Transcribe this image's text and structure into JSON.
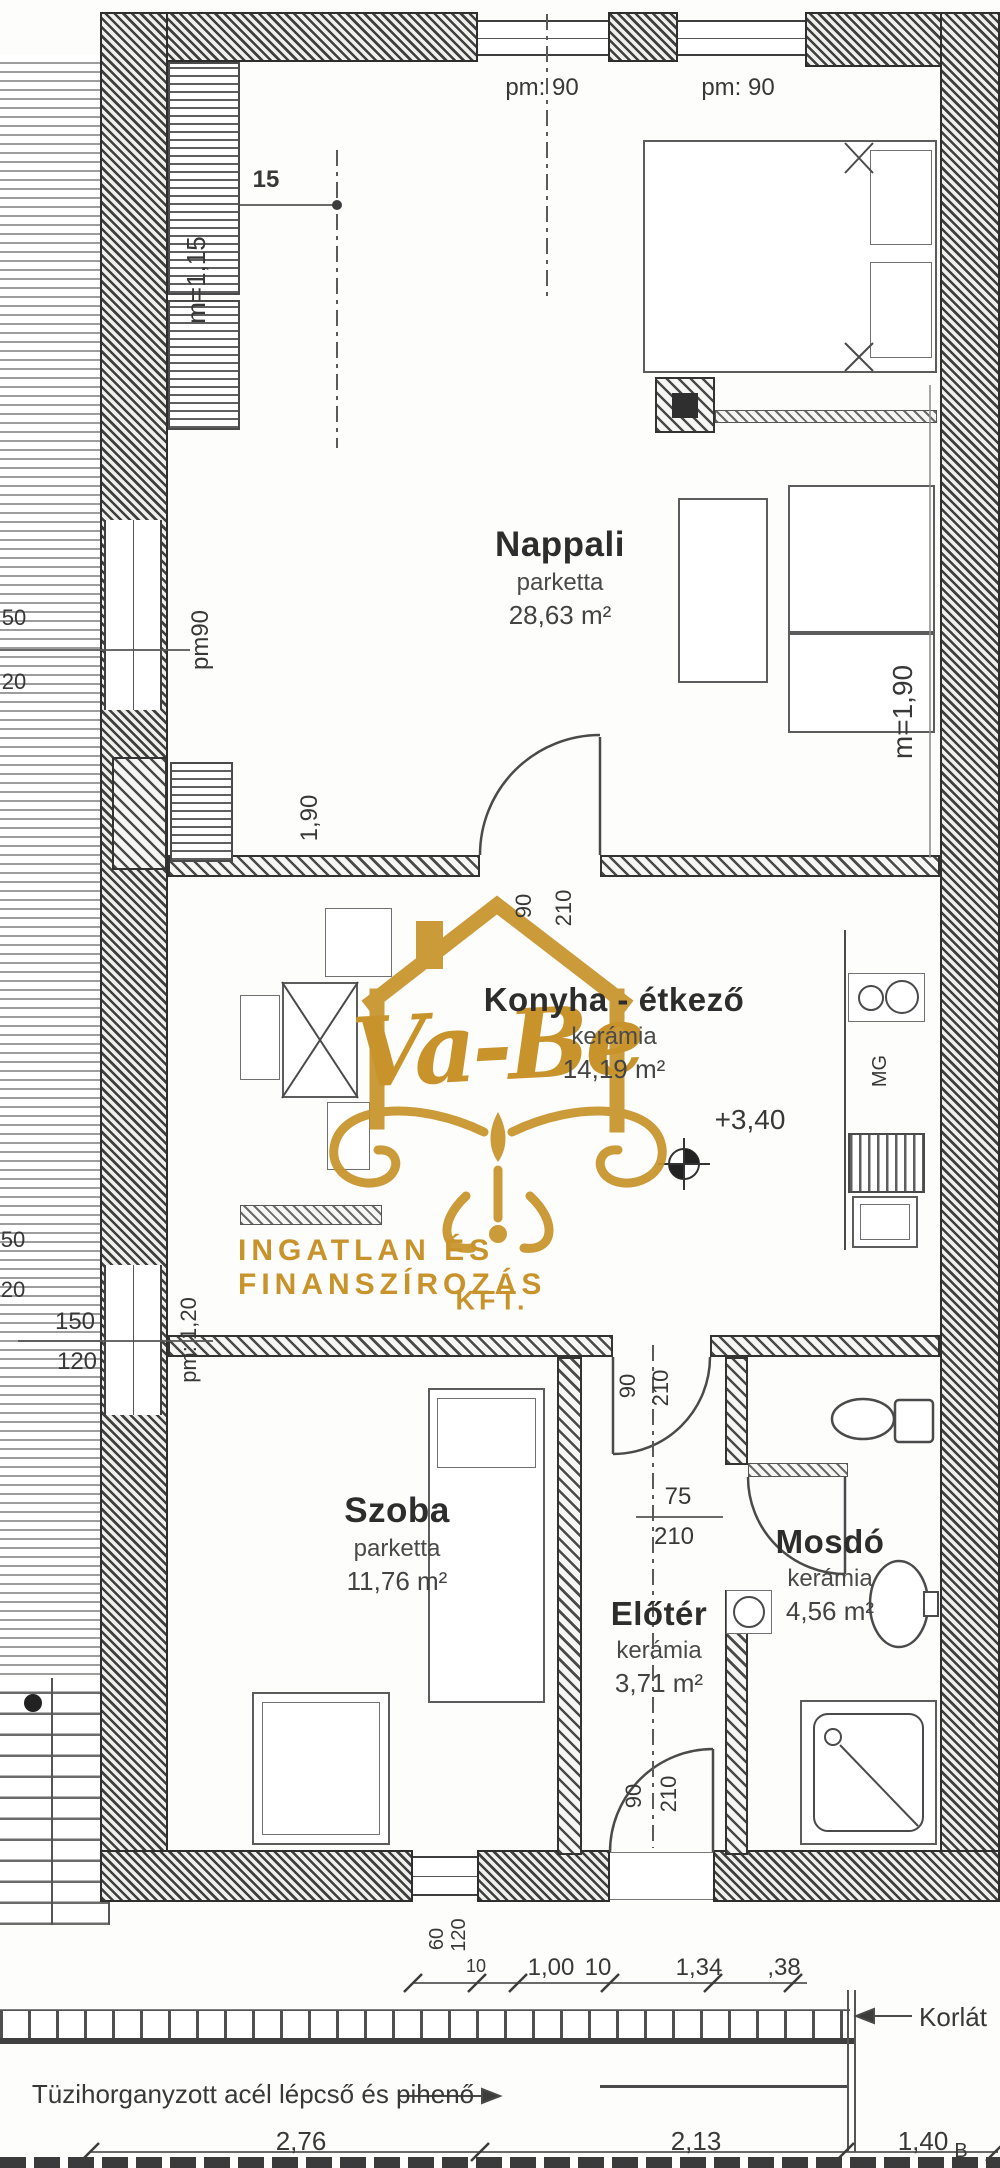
{
  "watermark": {
    "brand": "Va-Be",
    "line1": "INGATLAN ÉS FINANSZÍROZÁS",
    "line2": "KFT.",
    "color": "#C8932B"
  },
  "rooms": {
    "nappali": {
      "name": "Nappali",
      "floor": "parketta",
      "area": "28,63 m²"
    },
    "konyha": {
      "name": "Konyha - étkező",
      "floor": "kerámia",
      "area": "14,19 m²"
    },
    "szoba": {
      "name": "Szoba",
      "floor": "parketta",
      "area": "11,76 m²"
    },
    "eloter": {
      "name": "Előtér",
      "floor": "kerámia",
      "area": "3,71 m²"
    },
    "mosdo": {
      "name": "Mosdó",
      "floor": "kerámia",
      "area": "4,56 m²"
    }
  },
  "levels": {
    "elevation": "+3,40",
    "section_mark": "B"
  },
  "heights": {
    "left": "m=1,15",
    "right": "m=1,90"
  },
  "notes": {
    "stairs": "Tüzihorganyzott acél lépcső és pihenő",
    "railing": "Korlát",
    "dishwasher": "MG"
  },
  "labels": [
    {
      "n": "window-top1-label",
      "t": "pm: 90",
      "x": 542,
      "y": 88,
      "s": 24
    },
    {
      "n": "window-top2-label",
      "t": "pm: 90",
      "x": 738,
      "y": 88,
      "s": 24
    },
    {
      "n": "dim-15",
      "t": "15",
      "x": 266,
      "y": 180,
      "s": 24,
      "b": 1
    },
    {
      "n": "height-left-label",
      "t": "m=1,15",
      "x": 196,
      "y": 280,
      "s": 26,
      "r": -90
    },
    {
      "n": "dim-50-a",
      "t": "50",
      "x": 14,
      "y": 618,
      "s": 22
    },
    {
      "n": "dim-20-a",
      "t": "20",
      "x": 14,
      "y": 682,
      "s": 22
    },
    {
      "n": "window-left1-label",
      "t": "pm90",
      "x": 201,
      "y": 640,
      "s": 24,
      "r": -90
    },
    {
      "n": "dim-1-90",
      "t": "1,90",
      "x": 310,
      "y": 818,
      "s": 24,
      "r": -90
    },
    {
      "n": "door1-width",
      "t": "90",
      "x": 524,
      "y": 906,
      "s": 22,
      "r": -90
    },
    {
      "n": "door1-height",
      "t": "210",
      "x": 564,
      "y": 908,
      "s": 22,
      "r": -90
    },
    {
      "n": "height-right-label",
      "t": "m=1,90",
      "x": 903,
      "y": 712,
      "s": 28,
      "r": -90
    },
    {
      "n": "elevation-label",
      "t": "+3,40",
      "x": 750,
      "y": 1120,
      "s": 28
    },
    {
      "n": "dishwasher-label",
      "t": "MG",
      "x": 880,
      "y": 1071,
      "s": 20,
      "r": -90
    },
    {
      "n": "dim-50-b",
      "t": "50",
      "x": 13,
      "y": 1240,
      "s": 22
    },
    {
      "n": "dim-20-b",
      "t": "20",
      "x": 13,
      "y": 1290,
      "s": 22
    },
    {
      "n": "dim-150",
      "t": "150",
      "x": 75,
      "y": 1322,
      "s": 24
    },
    {
      "n": "dim-120",
      "t": "120",
      "x": 77,
      "y": 1362,
      "s": 24
    },
    {
      "n": "window-left2-label",
      "t": "pm: 1,20",
      "x": 189,
      "y": 1340,
      "s": 22,
      "r": -90
    },
    {
      "n": "door2-width",
      "t": "90",
      "x": 628,
      "y": 1386,
      "s": 22,
      "r": -90
    },
    {
      "n": "door2-height",
      "t": "210",
      "x": 661,
      "y": 1388,
      "s": 22,
      "r": -90
    },
    {
      "n": "door-mosdo-width",
      "t": "75",
      "x": 678,
      "y": 1497,
      "s": 24
    },
    {
      "n": "door-mosdo-height",
      "t": "210",
      "x": 674,
      "y": 1537,
      "s": 24
    },
    {
      "n": "door3-width",
      "t": "90",
      "x": 634,
      "y": 1796,
      "s": 22,
      "r": -90
    },
    {
      "n": "door3-height",
      "t": "210",
      "x": 669,
      "y": 1794,
      "s": 22,
      "r": -90
    },
    {
      "n": "dim-60",
      "t": "60",
      "x": 437,
      "y": 1939,
      "s": 20,
      "r": -90
    },
    {
      "n": "dim-120-b",
      "t": "120",
      "x": 459,
      "y": 1935,
      "s": 20,
      "r": -90
    },
    {
      "n": "dim-10-a",
      "t": "10",
      "x": 476,
      "y": 1966,
      "s": 18
    },
    {
      "n": "dim-1-00",
      "t": "1,00",
      "x": 551,
      "y": 1968,
      "s": 24
    },
    {
      "n": "dim-10-b",
      "t": "10",
      "x": 598,
      "y": 1968,
      "s": 24
    },
    {
      "n": "dim-1-34",
      "t": "1,34",
      "x": 699,
      "y": 1968,
      "s": 24
    },
    {
      "n": "dim-38",
      "t": ",38",
      "x": 784,
      "y": 1968,
      "s": 24
    },
    {
      "n": "railing-label",
      "t": "Korlát",
      "x": 953,
      "y": 2017,
      "s": 26
    },
    {
      "n": "stairs-note",
      "t": "Tüzihorganyzott acél lépcső és pihenő",
      "x": 253,
      "y": 2094,
      "s": 26
    },
    {
      "n": "dim-2-76",
      "t": "2,76",
      "x": 301,
      "y": 2141,
      "s": 26
    },
    {
      "n": "dim-2-13",
      "t": "2,13",
      "x": 696,
      "y": 2141,
      "s": 26
    },
    {
      "n": "dim-1-40",
      "t": "1,40",
      "x": 923,
      "y": 2141,
      "s": 26
    },
    {
      "n": "section-mark-b",
      "t": "B",
      "x": 961,
      "y": 2151,
      "s": 20
    }
  ]
}
